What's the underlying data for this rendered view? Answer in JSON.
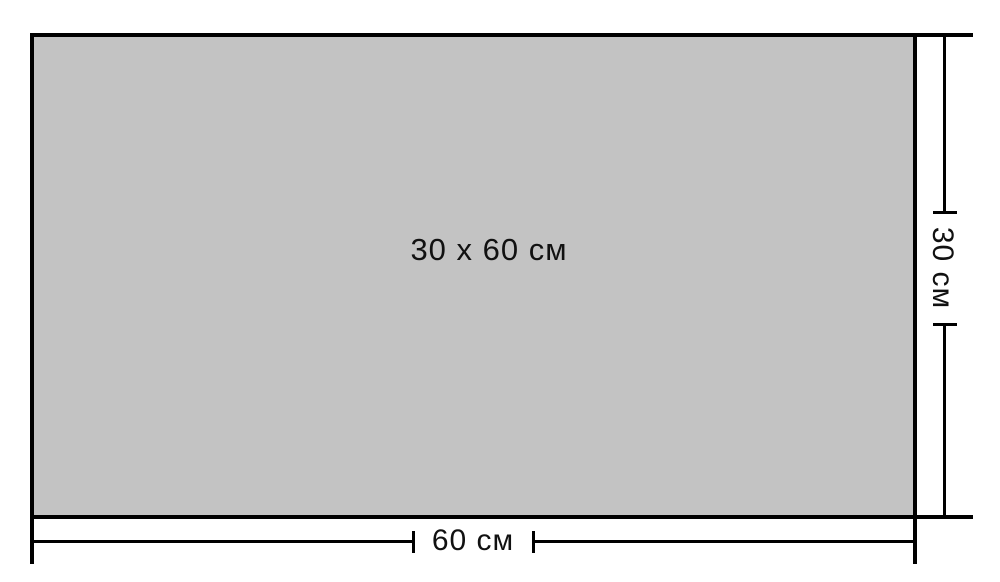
{
  "diagram": {
    "tile_label": "30 x 60 см",
    "width_dimension": {
      "label": "60 см"
    },
    "height_dimension": {
      "label": "30 см"
    },
    "colors": {
      "tile_fill": "#c3c3c3",
      "line": "#000000",
      "background": "#ffffff",
      "text": "#111111"
    }
  }
}
